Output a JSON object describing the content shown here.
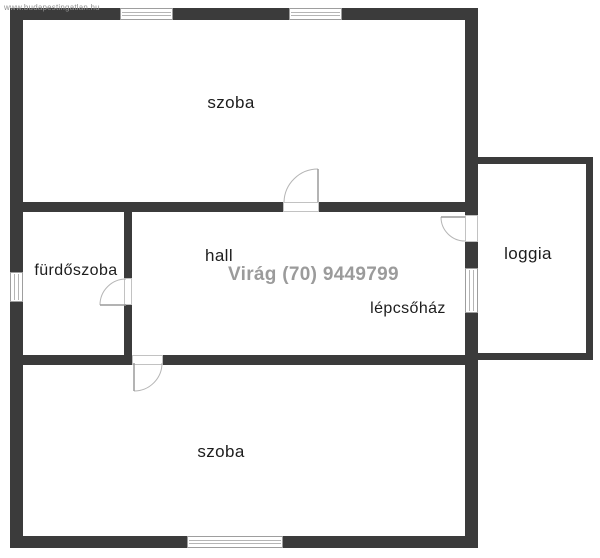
{
  "watermark": {
    "site": "www.budapestingatlan.hu",
    "agent": "Virág (70) 9449799"
  },
  "rooms": [
    {
      "id": "szoba-top",
      "label": "szoba"
    },
    {
      "id": "hall",
      "label": "hall"
    },
    {
      "id": "furdoszoba",
      "label": "fürdőszoba"
    },
    {
      "id": "lepcsohaz",
      "label": "lépcsőház"
    },
    {
      "id": "loggia",
      "label": "loggia"
    },
    {
      "id": "szoba-bottom",
      "label": "szoba"
    }
  ],
  "colors": {
    "wall": "#3b3b3b",
    "label_text": "#1d1d1d",
    "agent_watermark": "#9b9b9b",
    "window_line": "#9e9e9e",
    "door_arc": "#b5b5b5"
  }
}
